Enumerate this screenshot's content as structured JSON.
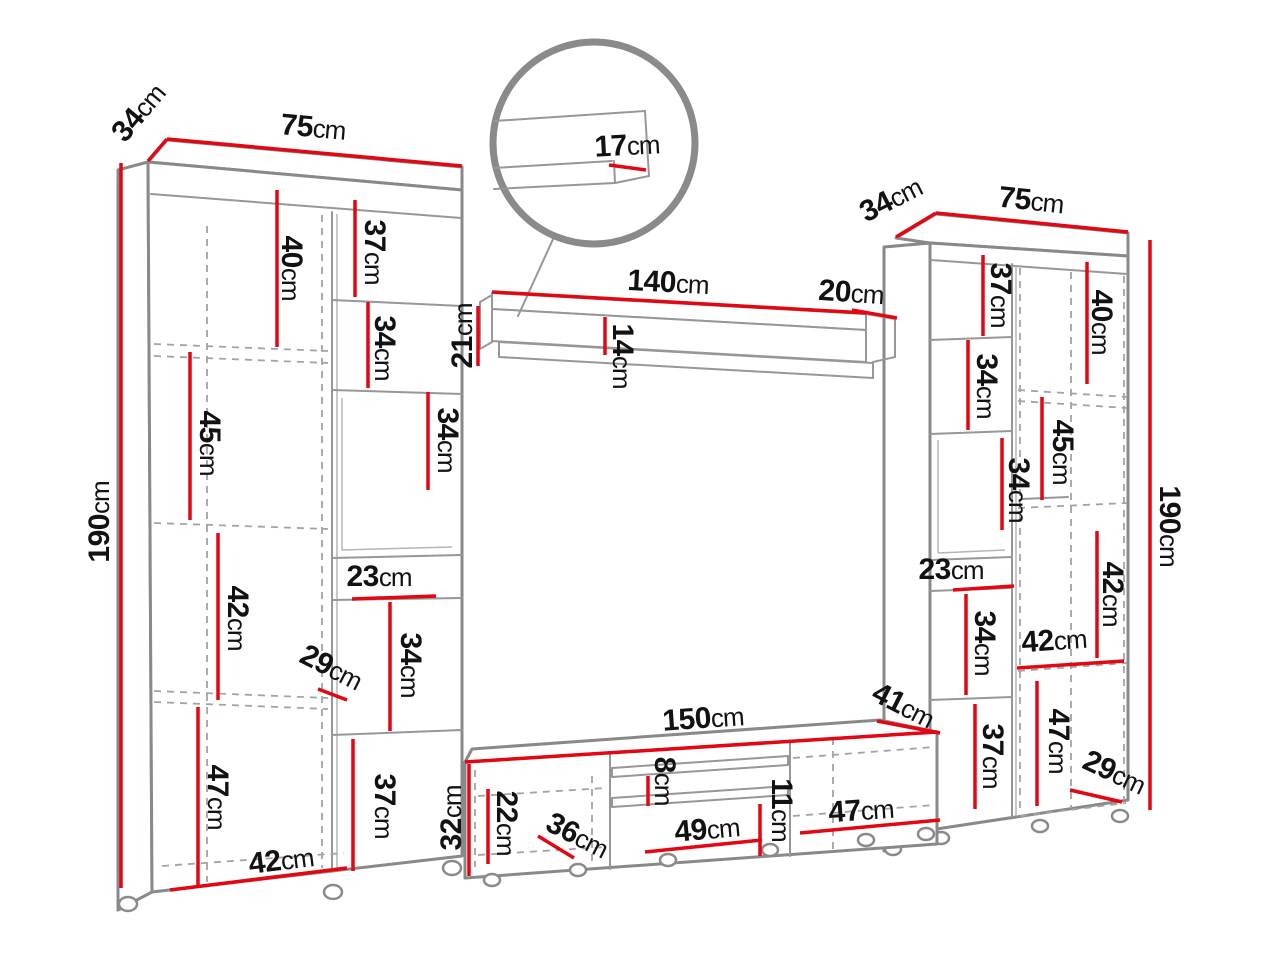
{
  "title": "Wall unit furniture dimensions diagram",
  "unit": "cm",
  "colors": {
    "dimension_red": "#e30613",
    "outline_gray": "#898989",
    "label_black": "#121212"
  },
  "left_cabinet": {
    "depth": {
      "value": "34",
      "unit": "cm"
    },
    "width": {
      "value": "75",
      "unit": "cm"
    },
    "height": {
      "value": "190",
      "unit": "cm"
    },
    "door_shelf_1": {
      "value": "40",
      "unit": "cm"
    },
    "door_shelf_2": {
      "value": "45",
      "unit": "cm"
    },
    "door_shelf_3": {
      "value": "42",
      "unit": "cm"
    },
    "door_shelf_4": {
      "value": "47",
      "unit": "cm"
    },
    "door_width": {
      "value": "42",
      "unit": "cm"
    },
    "shelf_offset": {
      "value": "29",
      "unit": "cm"
    },
    "compartment_1": {
      "value": "37",
      "unit": "cm"
    },
    "compartment_2": {
      "value": "34",
      "unit": "cm"
    },
    "niche_height": {
      "value": "34",
      "unit": "cm"
    },
    "niche_depth": {
      "value": "23",
      "unit": "cm"
    },
    "compartment_3": {
      "value": "34",
      "unit": "cm"
    },
    "compartment_4": {
      "value": "37",
      "unit": "cm"
    }
  },
  "wall_shelf": {
    "width": {
      "value": "140",
      "unit": "cm"
    },
    "depth": {
      "value": "20",
      "unit": "cm"
    },
    "height": {
      "value": "21",
      "unit": "cm"
    },
    "front_height": {
      "value": "14",
      "unit": "cm"
    },
    "lip_detail": {
      "value": "17",
      "unit": "cm"
    }
  },
  "right_cabinet": {
    "depth": {
      "value": "34",
      "unit": "cm"
    },
    "width": {
      "value": "75",
      "unit": "cm"
    },
    "height": {
      "value": "190",
      "unit": "cm"
    },
    "door_shelf_1": {
      "value": "40",
      "unit": "cm"
    },
    "door_shelf_2": {
      "value": "45",
      "unit": "cm"
    },
    "door_shelf_3": {
      "value": "42",
      "unit": "cm"
    },
    "shelf_width": {
      "value": "42",
      "unit": "cm"
    },
    "door_shelf_4": {
      "value": "47",
      "unit": "cm"
    },
    "shelf_offset": {
      "value": "29",
      "unit": "cm"
    },
    "compartment_1": {
      "value": "37",
      "unit": "cm"
    },
    "compartment_2": {
      "value": "34",
      "unit": "cm"
    },
    "niche_height": {
      "value": "34",
      "unit": "cm"
    },
    "niche_depth": {
      "value": "23",
      "unit": "cm"
    },
    "compartment_3": {
      "value": "34",
      "unit": "cm"
    },
    "compartment_4": {
      "value": "37",
      "unit": "cm"
    }
  },
  "tv_stand": {
    "width": {
      "value": "150",
      "unit": "cm"
    },
    "depth": {
      "value": "41",
      "unit": "cm"
    },
    "height": {
      "value": "32",
      "unit": "cm"
    },
    "compartment_height": {
      "value": "22",
      "unit": "cm"
    },
    "left_width": {
      "value": "36",
      "unit": "cm"
    },
    "shelf_gap": {
      "value": "8",
      "unit": "cm"
    },
    "center_width": {
      "value": "49",
      "unit": "cm"
    },
    "right_gap": {
      "value": "11",
      "unit": "cm"
    },
    "right_width": {
      "value": "47",
      "unit": "cm"
    }
  }
}
